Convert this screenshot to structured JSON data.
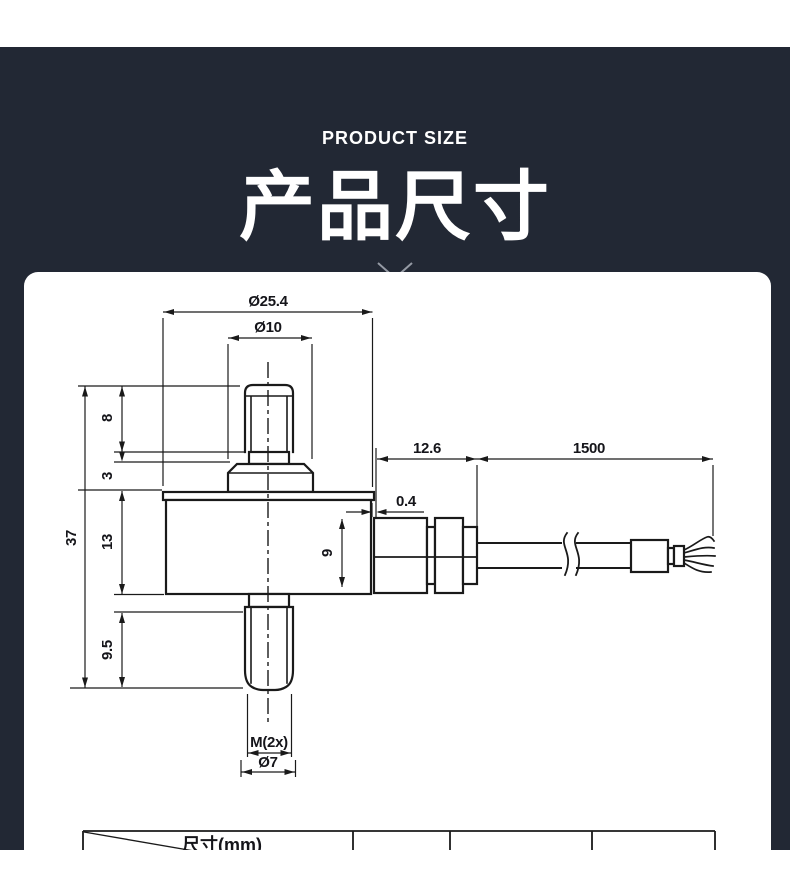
{
  "header": {
    "eyebrow": "PRODUCT SIZE",
    "title": "产品尺寸"
  },
  "colors": {
    "section_background": "#222834",
    "card_background": "#ffffff",
    "drawing_line": "#1a1a1a",
    "chevron": "#959aa4"
  },
  "drawing": {
    "dim_labels": {
      "flange_diameter": "Ø25.4",
      "boss_diameter": "Ø10",
      "top_stud_length": "8",
      "boss_height": "3",
      "overall_height": "37",
      "body_height": "13",
      "bottom_stud_length": "9.5",
      "connector_length": "12.6",
      "cable_length": "1500",
      "flange_lip": "0.4",
      "connector_diameter": "9",
      "thread_spec": "M(2x)",
      "stud_diameter": "Ø7"
    }
  },
  "table": {
    "corner_header": "尺寸(mm)"
  }
}
